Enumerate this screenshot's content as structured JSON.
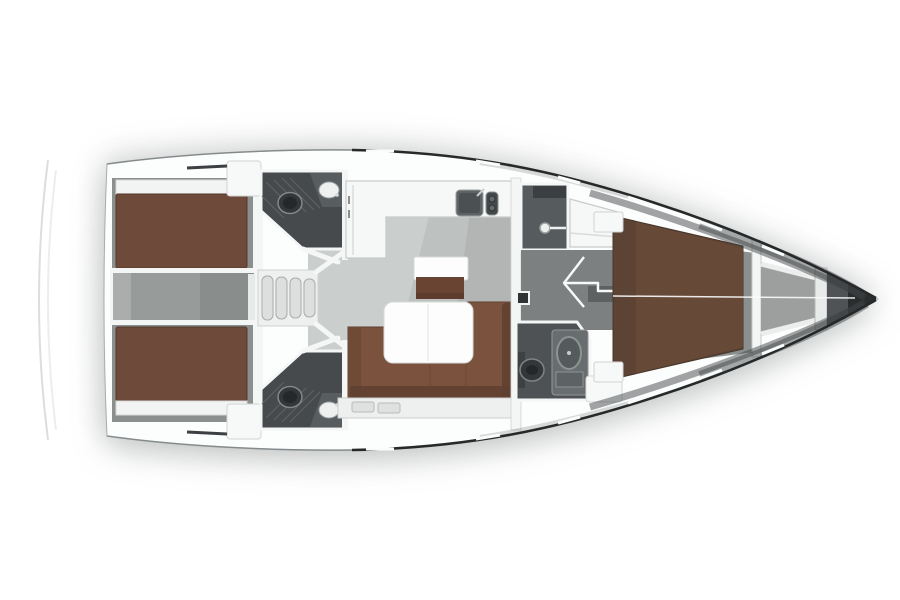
{
  "scene": {
    "subject": "sailing-yacht-interior-floorplan",
    "view": "top-down",
    "orientation": "bow-right"
  },
  "inventory": {
    "aft_double_cabins": 2,
    "aft_heads_with_toilet_and_sink": 2,
    "shower_compartments": 1,
    "forward_heads": 1,
    "forward_v_berth_cabins": 1,
    "companionway_step_count": 4,
    "salon_sofa_count": 1,
    "salon_table_count": 1,
    "nav_seat_count": 1,
    "galley_sink_count": 1,
    "galley_stove_count": 1
  },
  "colors": {
    "background": "#ffffff",
    "hull_white": "#fcfdfd",
    "hull_edge": "#a7acac",
    "deck_locker_white": "#f7f8f8",
    "salon_floor": "#bdc1c0",
    "salon_floor_light": "#eef0ef",
    "salon_floor_dark": "#7e8281",
    "cabin_floor": "#8b8f8e",
    "corridor_floor": "#7c8080",
    "door_recess": "#5d6162",
    "engine_gray": "#979b9a",
    "engine_gray_dark": "#7e8282",
    "engine_gray_light": "#b2b5b4",
    "steps_frame": "#eef0ef",
    "steps_tread": "#dddfde",
    "berth_aft": "#6d4a39",
    "berth_fwd": "#5c4334",
    "berth_fwd_light": "#6e4e3c",
    "sofa": "#7a523d",
    "sofa_dark": "#5f4030",
    "armrest": "#6f4a37",
    "nav_seat": "#6a4433",
    "table_white": "#fdfdfd",
    "bath_floor": "#464a4c",
    "counter_dark": "#585d5f",
    "shower_floor": "#565b5d",
    "shower_cabinet": "#3b3f41",
    "head_fwd_floor": "#4e5254",
    "fixture_dark": "#33373a",
    "fixture_core": "#25282a",
    "fixture_light": "#eef0f0",
    "sink_unit_gray": "#686d6f",
    "basin_gray": "#555a5c",
    "galley_counter": "#f6f7f7",
    "galley_sink": "#5d6264",
    "galley_sink_bowl": "#4b5052",
    "galley_stove": "#43484a",
    "bulkhead_white": "#f4f5f5",
    "forepeak_gray": "#9c9f9e",
    "forepeak_bar": "#e9ebeb",
    "bow_cone": "#4f5355",
    "bow_tip": "#2a2d2e",
    "mast_dark": "#2f3334"
  }
}
